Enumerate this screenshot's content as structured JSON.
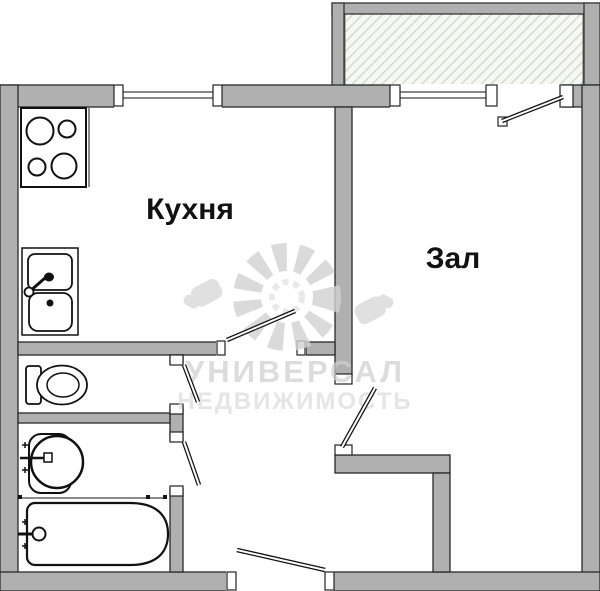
{
  "plan": {
    "type": "apartment-floor-plan",
    "rooms": {
      "kitchen_label": "Кухня",
      "living_label": "Зал"
    },
    "watermark": {
      "line1": "УНИВЕРСАЛ",
      "line2": "НЕДВИЖИМОСТЬ"
    },
    "fixtures": {
      "stove": "stove-icon",
      "kitchen_sink": "kitchen-sink-icon",
      "toilet": "toilet-icon",
      "washbasin": "washbasin-icon",
      "bathtub": "bathtub-icon"
    },
    "colors": {
      "wall_fill": "#b0b0b0",
      "wall_outline": "#2a2a2a",
      "balcony_hatch_line": "#ccd8c8",
      "balcony_hatch_bg": "#f5f8f3",
      "watermark_gray": "#d2d2d2",
      "watermark_gray_light": "#dcdcdc",
      "label_color": "#111111"
    }
  }
}
